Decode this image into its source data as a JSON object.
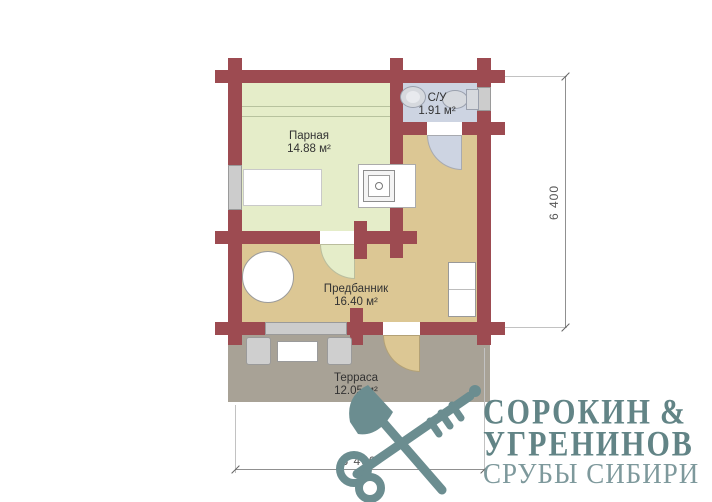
{
  "plan": {
    "rooms": {
      "parnaya": {
        "name": "Парная",
        "area": "14.88 м²"
      },
      "su": {
        "name": "С/У",
        "area": "1.91 м²"
      },
      "predbannik": {
        "name": "Предбанник",
        "area": "16.40 м²"
      },
      "terrasa": {
        "name": "Терраса",
        "area": "12.05 м²"
      }
    },
    "dimensions": {
      "width_label": "6 400",
      "height_label": "6 400"
    },
    "colors": {
      "wall": "#9d4b51",
      "parnaya_floor": "#e5edc9",
      "su_floor": "#cdd4e2",
      "predbannik_floor": "#dcc794",
      "terrace_floor": "#a8a296",
      "window": "#cccccc",
      "logo_teal": "#6b8d90",
      "logo_text": "#628486",
      "logo_tagline": "#7e999c"
    }
  },
  "logo": {
    "name_line1": "СОРОКИН",
    "ampersand": "&",
    "name_line2": "УГРЕНИНОВ",
    "tagline": "СРУБЫ СИБИРИ"
  }
}
